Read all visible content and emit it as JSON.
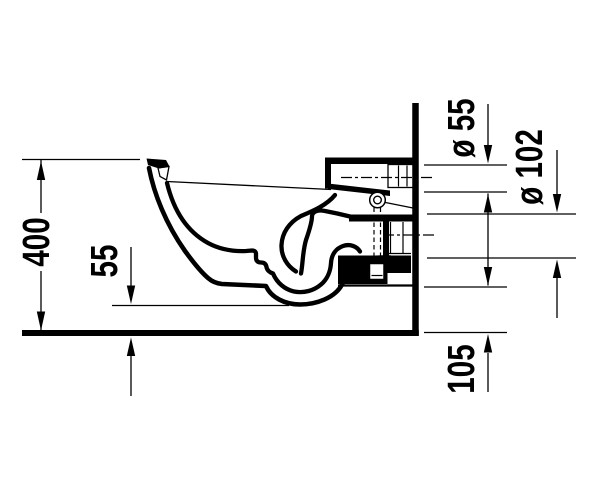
{
  "drawing": {
    "labels": {
      "overall_height": "400",
      "bowl_floor_clearance": "55",
      "flush_inlet_diameter": "ø 55",
      "outlet_diameter": "ø 102",
      "outlet_bottom_height": "105"
    },
    "colors": {
      "ink": "#000000",
      "background": "#ffffff"
    }
  }
}
